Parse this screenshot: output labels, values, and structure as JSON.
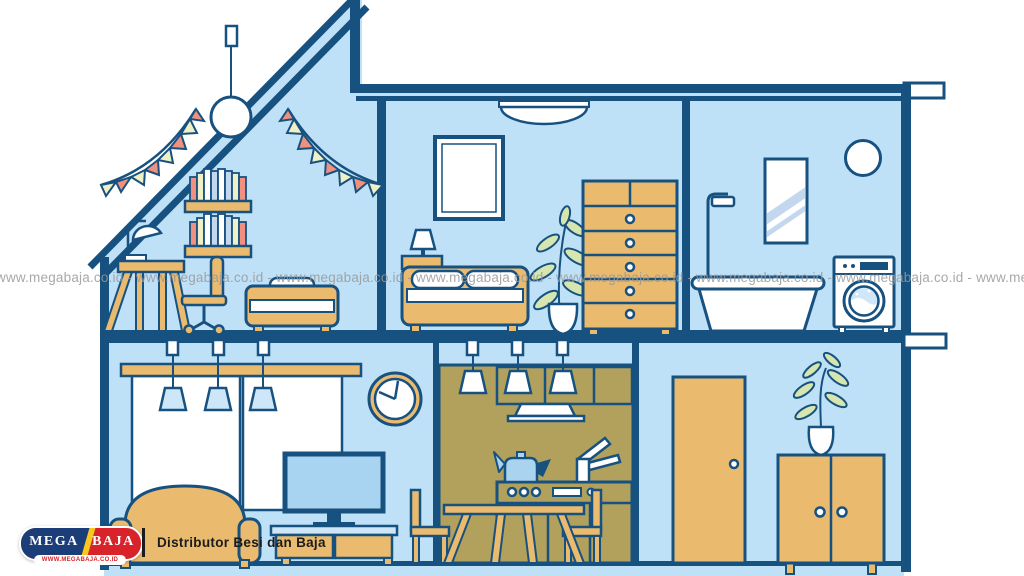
{
  "watermark": {
    "unit": "www.megabaja.co.id",
    "row": "www.megabaja.co.id - www.megabaja.co.id - www.megabaja.co.id - www.megabaja.co.id - www.megabaja.co.id - www.megabaja.co.id - www.megabaja.co.id - www.megabaja.co.id"
  },
  "logo": {
    "word_left": "MEGA",
    "word_right": "BAJA",
    "website": "WWW.MEGABAJA.CO.ID",
    "tagline": "Distributor Besi dan Baja"
  },
  "palette": {
    "outline_navy": "#175180",
    "wall_blue": "#bfe1f7",
    "wood_tan": "#eaba6e",
    "kitchen_olive": "#b1a15c",
    "flag_salmon": "#f2907f",
    "flag_cream": "#eff0c6",
    "leaf_green": "#d6e6ae",
    "screen_blue": "#a8d3f1",
    "lamp_blue": "#cde7f8",
    "logo_navy": "#1c3e78",
    "logo_red": "#d8232a",
    "logo_yellow": "#f8c81c",
    "watermark_gray": "#999999"
  }
}
